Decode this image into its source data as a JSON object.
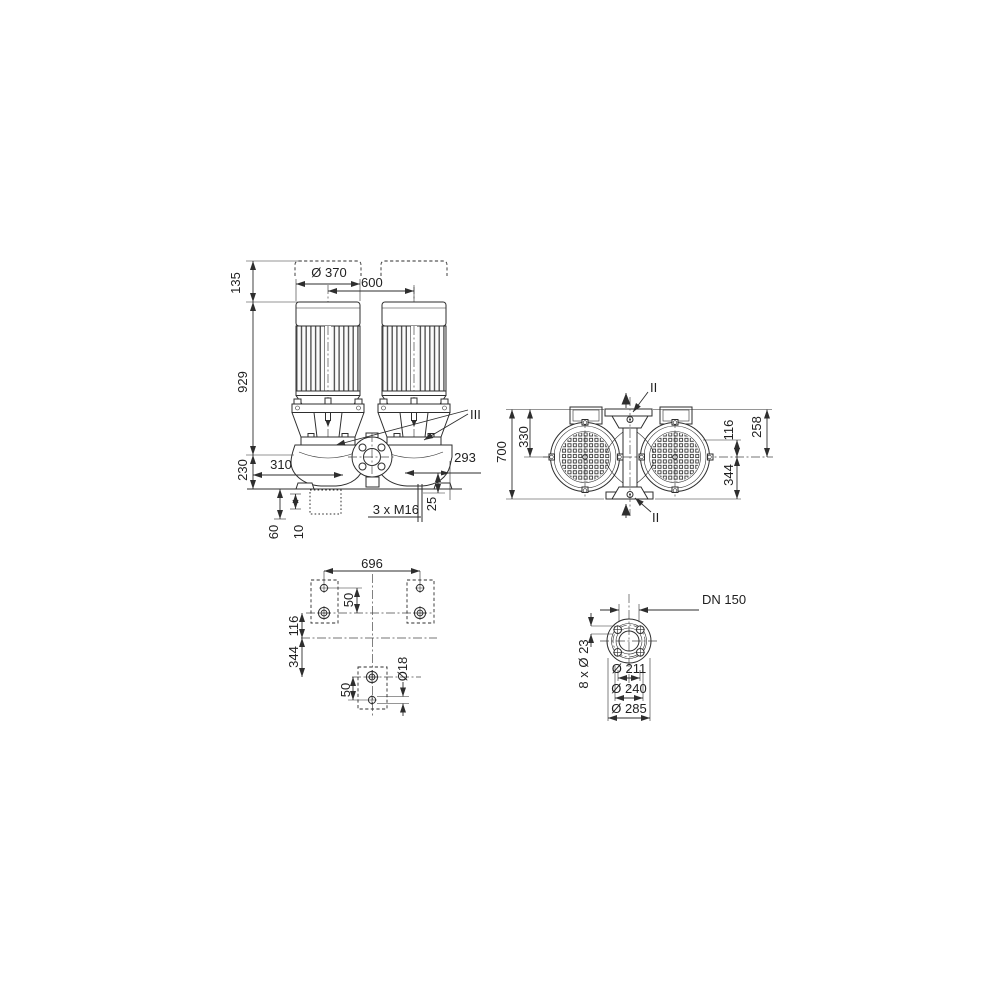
{
  "drawing": {
    "front_view": {
      "d135": "135",
      "dia370": "Ø 370",
      "d600": "600",
      "d929": "929",
      "d230": "230",
      "d310": "310",
      "d293": "293",
      "d25": "25",
      "tap": "3 x M16",
      "d60": "60",
      "d10": "10",
      "section_iii": "III"
    },
    "top_view": {
      "d700": "700",
      "d330": "330",
      "d116": "116",
      "d258": "258",
      "d344": "344",
      "section_ii_top": "II",
      "section_ii_bottom": "II"
    },
    "foundation_view": {
      "d696": "696",
      "d50_top": "50",
      "d116": "116",
      "d344": "344",
      "d50_bottom": "50",
      "dia18": "Ø18"
    },
    "flange_view": {
      "dn": "DN 150",
      "d211": "Ø 211",
      "d240": "Ø 240",
      "d285": "Ø 285",
      "bolts": "8 x Ø 23"
    }
  }
}
